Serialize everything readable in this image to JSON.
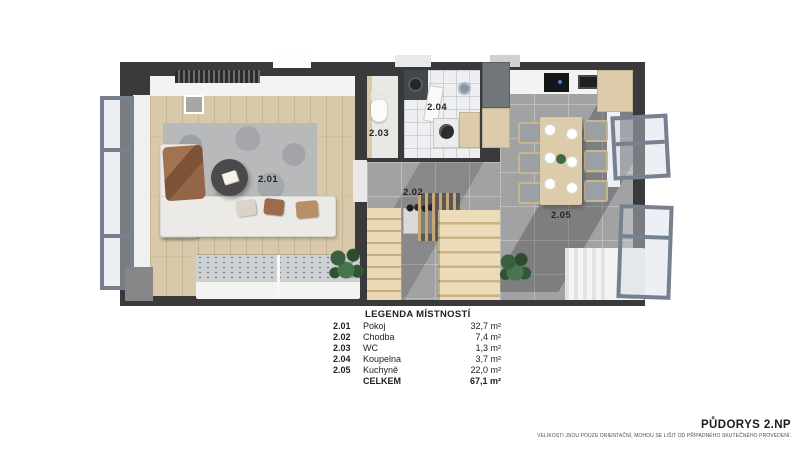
{
  "plan": {
    "room_labels": [
      {
        "id": "2.01"
      },
      {
        "id": "2.02"
      },
      {
        "id": "2.03"
      },
      {
        "id": "2.04"
      },
      {
        "id": "2.05"
      }
    ]
  },
  "legend": {
    "title": "LEGENDA MÍSTNOSTÍ",
    "rows": [
      {
        "code": "2.01",
        "name": "Pokoj",
        "area": "32,7 m²"
      },
      {
        "code": "2.02",
        "name": "Chodba",
        "area": "7,4 m²"
      },
      {
        "code": "2.03",
        "name": "WC",
        "area": "1,3 m²"
      },
      {
        "code": "2.04",
        "name": "Koupelna",
        "area": "3,7 m²"
      },
      {
        "code": "2.05",
        "name": "Kuchyně",
        "area": "22,0 m²"
      }
    ],
    "total": {
      "name": "CELKEM",
      "area": "67,1 m²"
    }
  },
  "footer": {
    "title": "PŮDORYS 2.NP",
    "disclaimer": "VELIKOSTI JSOU POUZE ORIENTAČNÍ, MOHOU SE LIŠIT OD PŘÍPADNÉHO SKUTEČNÉHO PROVEDENÍ."
  },
  "colors": {
    "wall": "#3a393b",
    "wood": "#d8c9ab",
    "tile": "#a2a2a4",
    "rug": "#b7b9bb",
    "white-f": "#f3f3f2",
    "beige": "#ddcca9",
    "frame": "#76818f",
    "ink": "#1f1f1f"
  }
}
